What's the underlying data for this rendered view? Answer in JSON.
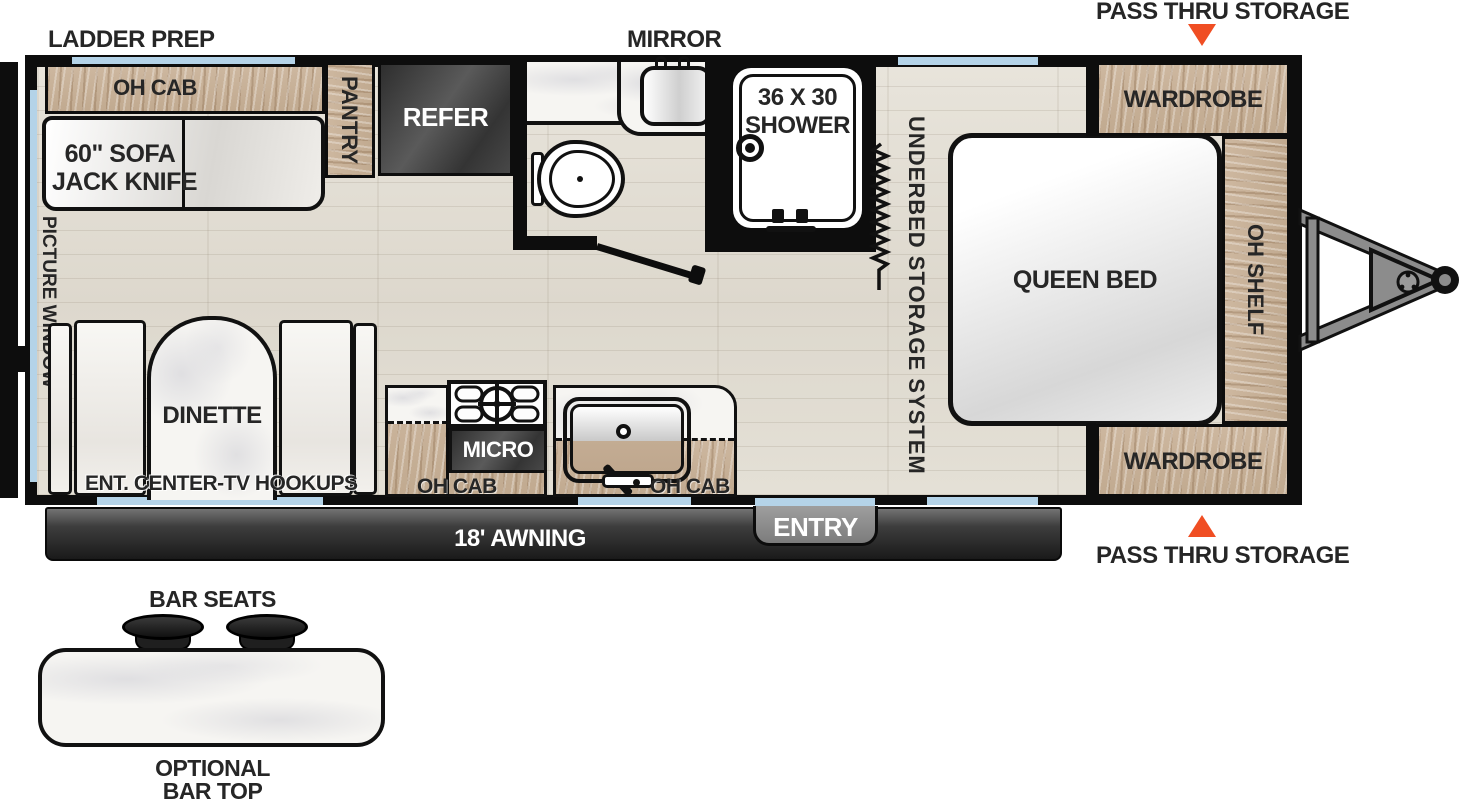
{
  "colors": {
    "wall": "#0d0d0d",
    "window_glass": "#b4d3e8",
    "cabinet_wood": "#c8b199",
    "appliance_dark": "#454545",
    "accent_orange": "#f04e23",
    "floor": "#e2ddd3"
  },
  "exterior": {
    "ladder_prep": "LADDER PREP",
    "mirror": "MIRROR",
    "pass_thru_storage_top": "PASS THRU STORAGE",
    "pass_thru_storage_bottom": "PASS THRU STORAGE",
    "awning": "18' AWNING",
    "entry": "ENTRY"
  },
  "interior": {
    "oh_cab_rear": "OH CAB",
    "sofa_line1": "60\" SOFA",
    "sofa_line2": "JACK KNIFE",
    "pantry": "PANTRY",
    "refer": "REFER",
    "shower_line1": "36 X 30",
    "shower_line2": "SHOWER",
    "underbed_storage": "UNDERBED STORAGE SYSTEM",
    "queen_bed": "QUEEN BED",
    "wardrobe_top": "WARDROBE",
    "wardrobe_bottom": "WARDROBE",
    "oh_shelf": "OH SHELF",
    "picture_window_line1": "PICTURE",
    "picture_window_line2": "WINDOW",
    "dinette": "DINETTE",
    "ent_center_tv": "ENT. CENTER-TV HOOKUPS",
    "micro": "MICRO",
    "oh_cab_kitchen_left": "OH CAB",
    "oh_cab_kitchen_right": "OH CAB"
  },
  "bar_option": {
    "bar_seats": "BAR SEATS",
    "optional_line1": "OPTIONAL",
    "optional_line2": "BAR TOP"
  }
}
